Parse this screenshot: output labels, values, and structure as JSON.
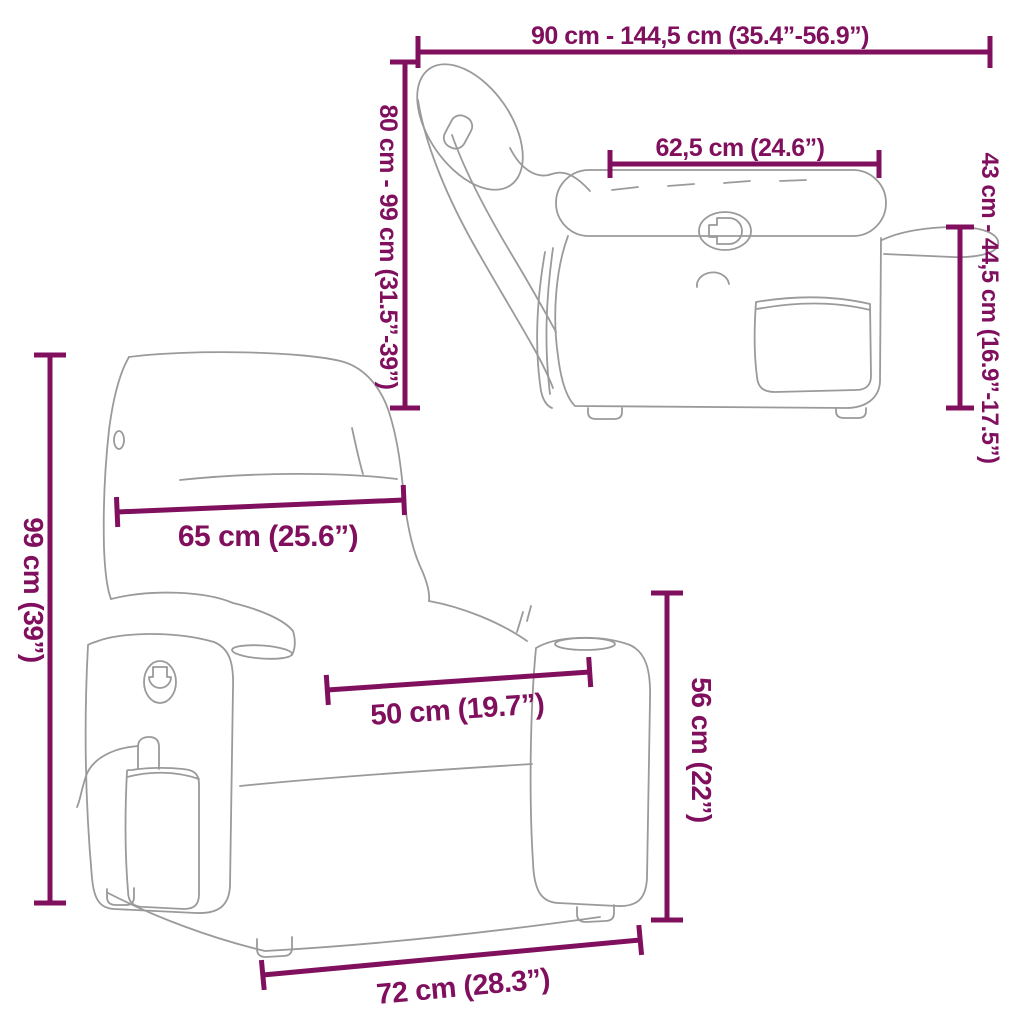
{
  "diagram": {
    "subject": "massage recliner chair dimension drawing",
    "colors": {
      "dimension_color": "#80105E",
      "outline_color": "#9A9A9A",
      "background": "#FFFFFF"
    },
    "side_view": {
      "overall_width_label": "90 cm - 144,5 cm (35.4”-56.9”)",
      "overall_height_label": "80 cm - 99 cm (31.5”-39”)",
      "armrest_length_label": "62,5 cm (24.6”)",
      "arm_height_label": "43 cm - 44,5 cm (16.9”-17.5”)"
    },
    "front_view": {
      "total_height_label": "99 cm (39”)",
      "backrest_width_label": "65 cm (25.6”)",
      "seat_width_label": "50 cm (19.7”)",
      "armrest_height_label": "56 cm (22”)",
      "base_width_label": "72 cm (28.3”)"
    }
  }
}
